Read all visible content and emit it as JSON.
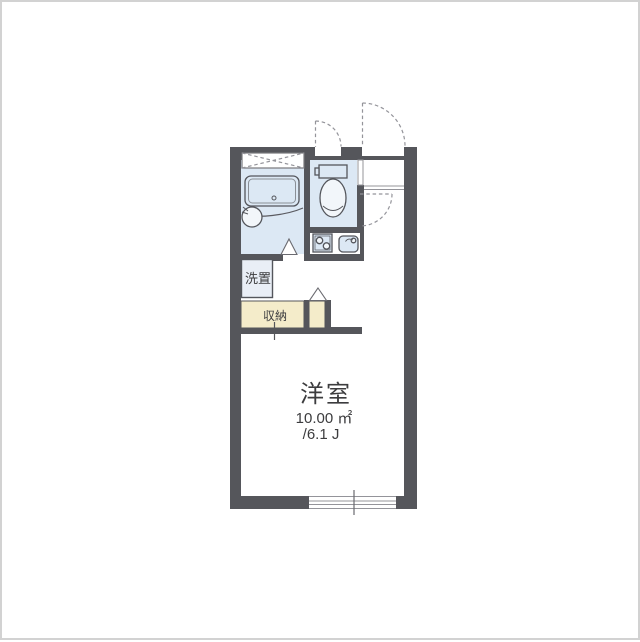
{
  "plan": {
    "type": "apartment-floor-plan",
    "rooms": {
      "main": {
        "name": "洋室",
        "area_m2": "10.00 ㎡",
        "area_j": "/6.1 J"
      },
      "washer": {
        "label": "洗置"
      },
      "closet": {
        "label": "収納"
      }
    },
    "colors": {
      "wall": "#55565b",
      "wet_area_fill": "#dce8f4",
      "storage_fill": "#f4ecca",
      "washer_fill": "#e9eef6",
      "outline": "#54565c",
      "dashed_line": "#94949a",
      "text": "#3c3c3e"
    }
  }
}
